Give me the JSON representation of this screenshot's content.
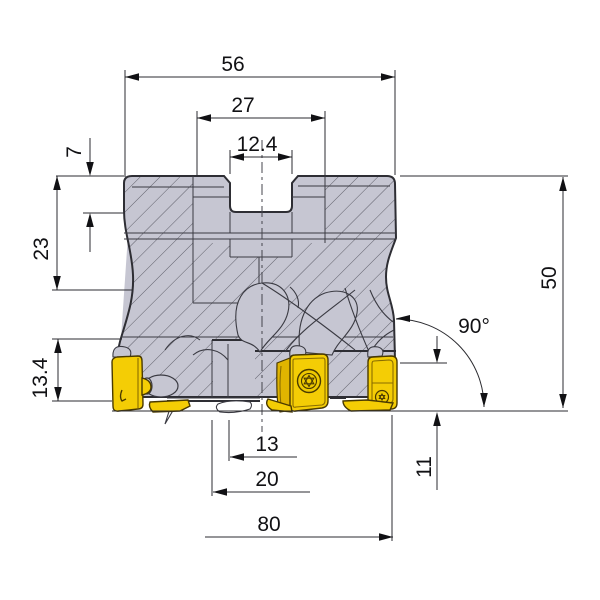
{
  "drawing": {
    "subject": "indexable-face-mill-cutter-cross-section-dimension-drawing",
    "view": "side cross-section with carbide inserts",
    "dimensions": {
      "body_top_width": "56",
      "recess_width": "27",
      "key_slot_width": "12.4",
      "key_slot_depth": "7",
      "upper_section_height": "23",
      "insert_pocket_height": "13.4",
      "overall_height": "50",
      "corner_angle": "90°",
      "insert_edge_length": "11",
      "inner_bore_half": "13",
      "bore_half": "20",
      "cutting_diameter_half": "80"
    },
    "colors": {
      "background": "#ffffff",
      "body_gray": "#c6c6d2",
      "body_outline": "#2e2e34",
      "hatch_line": "#5f5f6a",
      "insert_yellow": "#f4cd05",
      "insert_outline": "#4a3a00",
      "dimension_line": "#2b2b30",
      "text": "#111114"
    }
  }
}
